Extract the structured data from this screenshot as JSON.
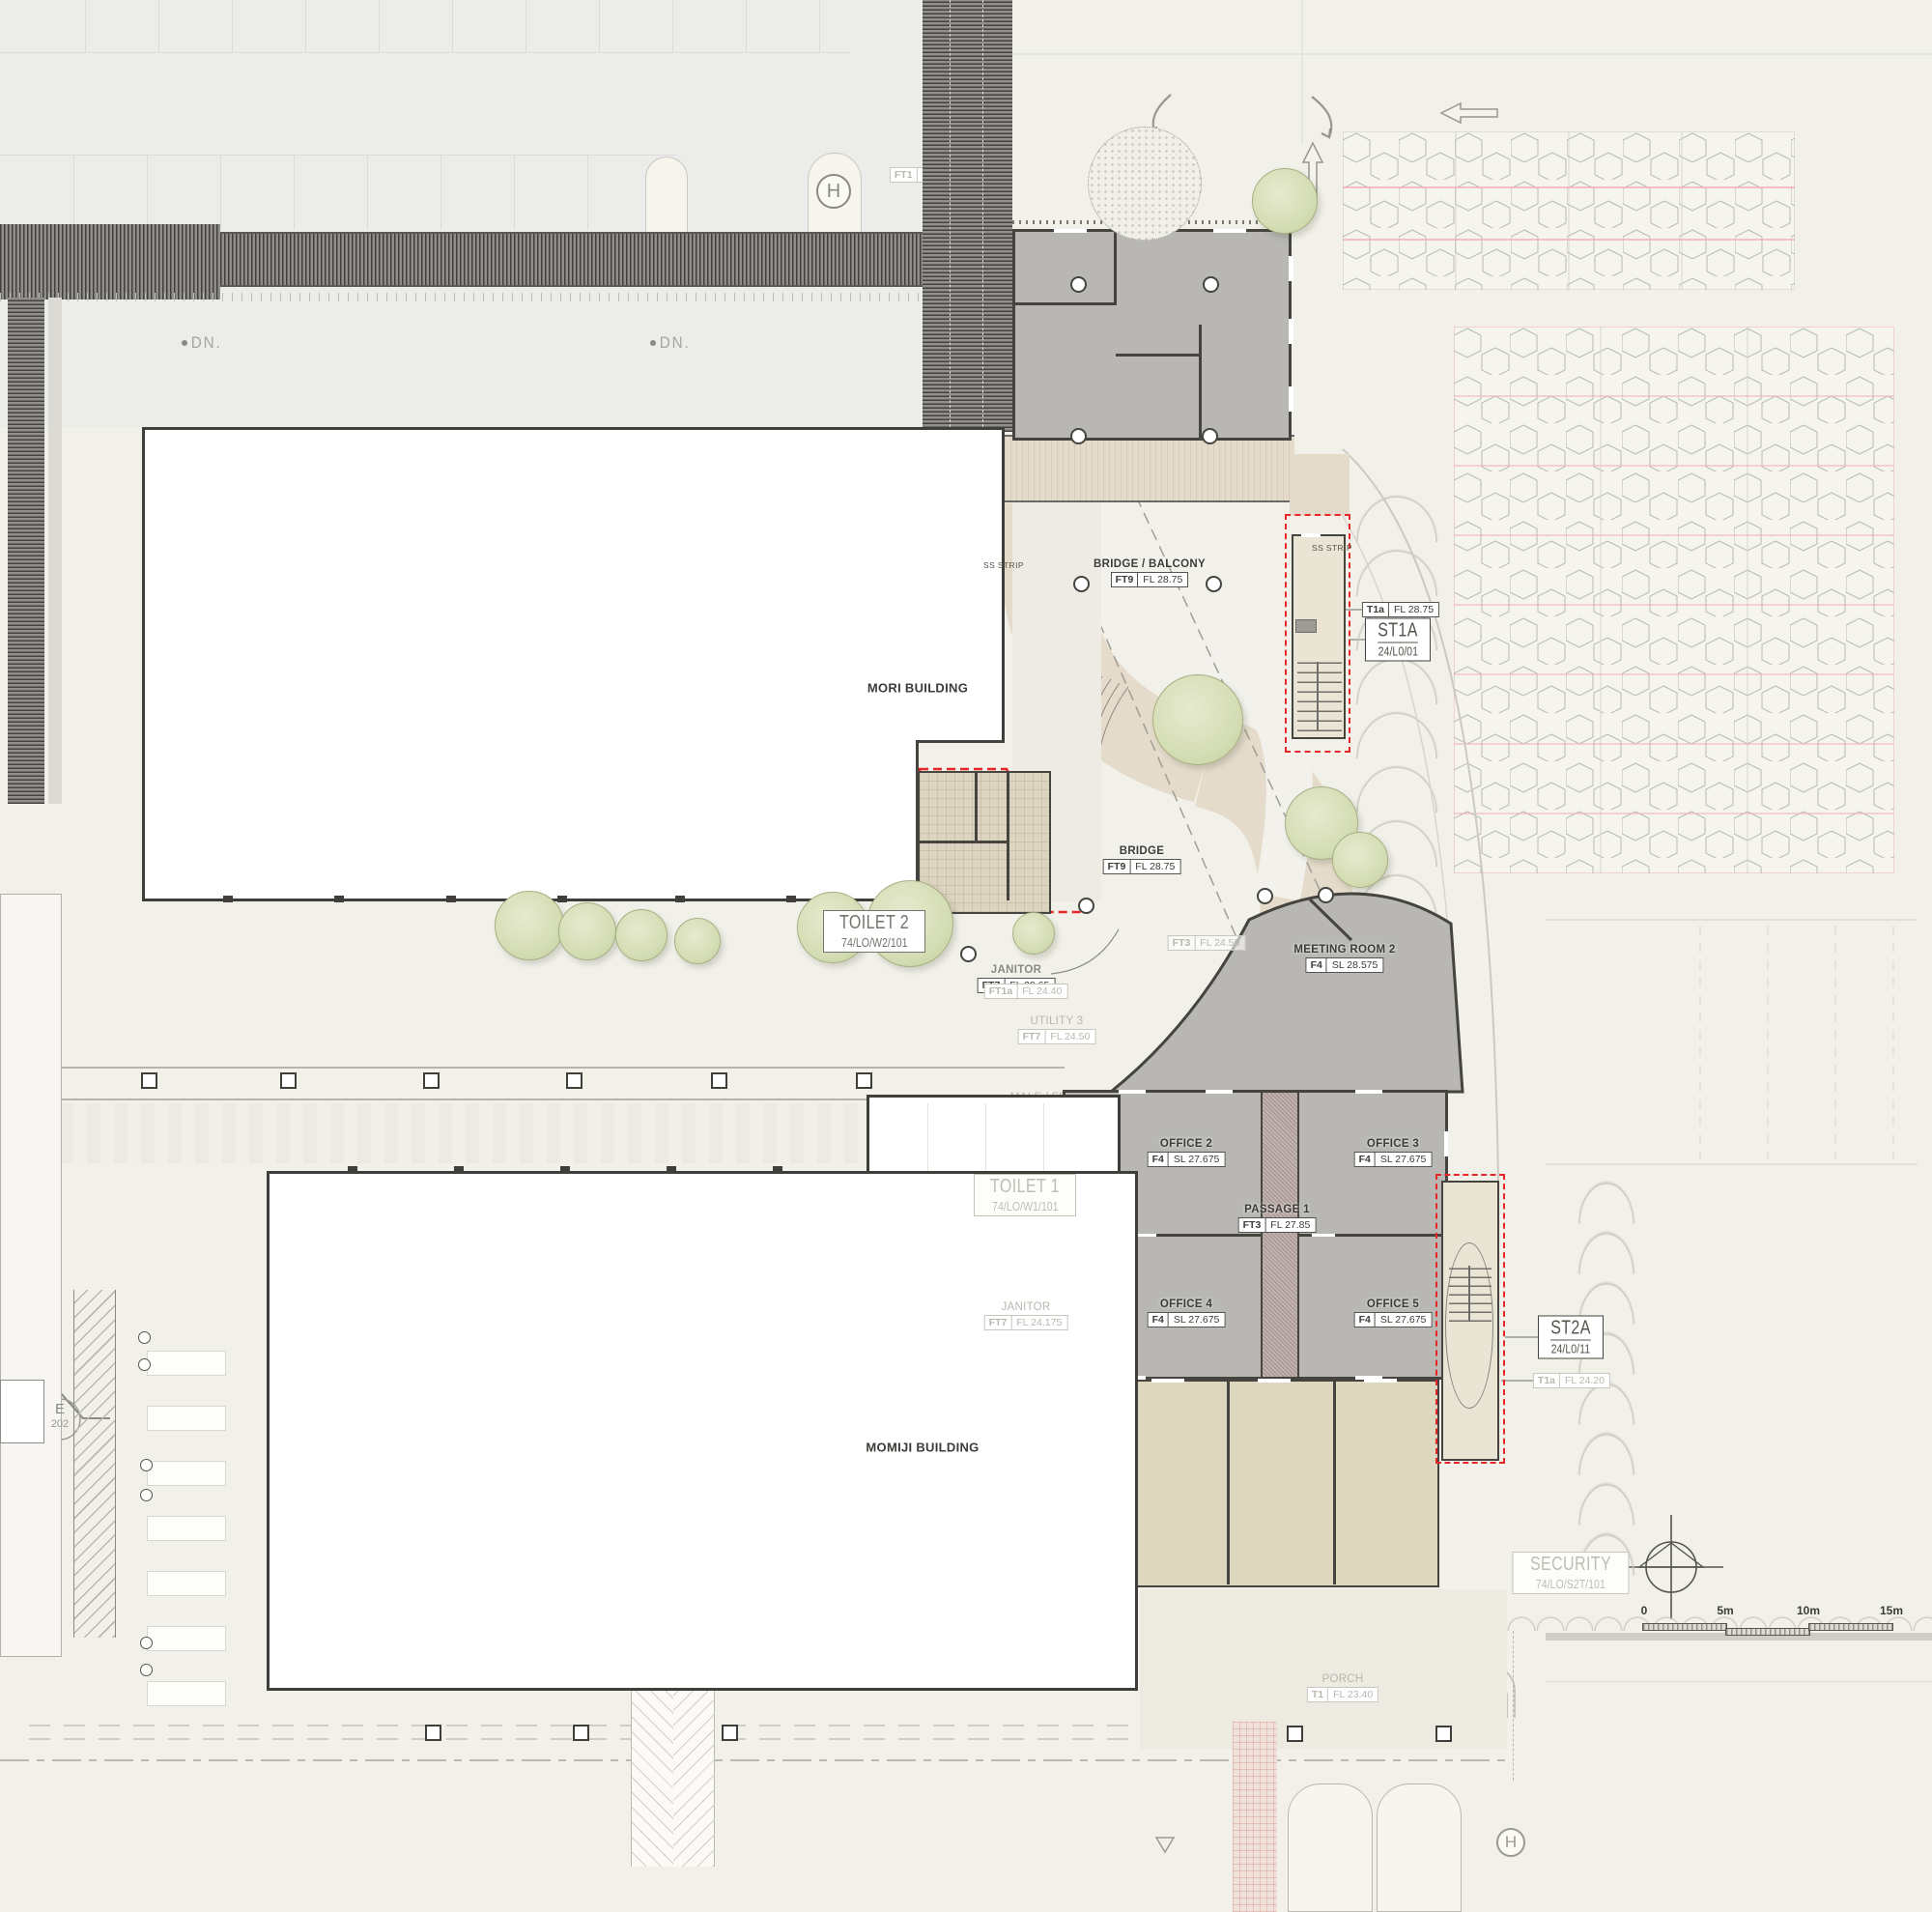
{
  "buildings": {
    "mori": "MORI BUILDING",
    "momiji": "MOMIJI BUILDING"
  },
  "rooms": {
    "bridge_balcony": {
      "name": "BRIDGE / BALCONY",
      "code": "FT9",
      "value": "FL 28.75"
    },
    "bridge": {
      "name": "BRIDGE",
      "code": "FT9",
      "value": "FL 28.75"
    },
    "meeting_room_2": {
      "name": "MEETING ROOM 2",
      "code": "F4",
      "value": "SL 28.575"
    },
    "office_2": {
      "name": "OFFICE 2",
      "code": "F4",
      "value": "SL 27.675"
    },
    "office_3": {
      "name": "OFFICE 3",
      "code": "F4",
      "value": "SL 27.675"
    },
    "office_4": {
      "name": "OFFICE 4",
      "code": "F4",
      "value": "SL 27.675"
    },
    "office_5": {
      "name": "OFFICE 5",
      "code": "F4",
      "value": "SL 27.675"
    },
    "passage_1": {
      "name": "PASSAGE 1",
      "code": "FT3",
      "value": "FL 27.85"
    },
    "janitor_upper": {
      "name": "JANITOR",
      "code": "FT7",
      "value": "FL 28.65"
    },
    "janitor_upper_alt": {
      "code": "FT1a",
      "value": "FL 24.40"
    },
    "utility_3": {
      "name": "UTILITY 3",
      "code": "FT7",
      "value": "FL 24.50"
    },
    "janitor_lower": {
      "name": "JANITOR",
      "code": "FT7",
      "value": "FL 24.175"
    },
    "male_fem_disable": {
      "name_line1": "MALE / FEM",
      "name_line2": "DISABLE",
      "code": "FT5",
      "value": "FL 2"
    },
    "porch": {
      "name": "PORCH",
      "code": "T1",
      "value": "FL 23.40"
    },
    "courtyard": {
      "code": "FT3",
      "value": "FL 24.50"
    },
    "walkway": {
      "code": "FT1",
      "value": "300X"
    }
  },
  "stairs": {
    "st1a": {
      "name": "ST1A",
      "ref": "24/L0/01",
      "tag_code": "T1a",
      "tag_value": "FL 28.75"
    },
    "st2a": {
      "name": "ST2A",
      "ref": "24/L0/11",
      "tag_code": "T1a",
      "tag_value": "FL 24.20"
    }
  },
  "toilets": {
    "toilet_1": {
      "name": "TOILET 1",
      "ref": "74/LO/W1/101"
    },
    "toilet_2": {
      "name": "TOILET 2",
      "ref": "74/LO/W2/101"
    }
  },
  "security": {
    "name": "SECURITY",
    "ref": "74/LO/S2T/101"
  },
  "markers": {
    "dn": "DN.",
    "ss_strip": "SS STRIP",
    "hydrant": "H",
    "section_letter": "E",
    "section_number": "202"
  },
  "scale_bar": {
    "tick_0": "0",
    "tick_5": "5m",
    "tick_10": "10m",
    "tick_15": "15m"
  },
  "colors": {
    "background": "#f1f0e9",
    "parking_bg": "#ececeb",
    "room_gray": "#b8b7b3",
    "wood_floor": "#e4dbca",
    "tan_room": "#ddd7c0",
    "stair_beige": "#e9e4d3",
    "wall": "#45443f",
    "red_dashed": "#e8262a",
    "pink_line": "#f2aeb4",
    "tree_green": "#d4ddb4"
  }
}
